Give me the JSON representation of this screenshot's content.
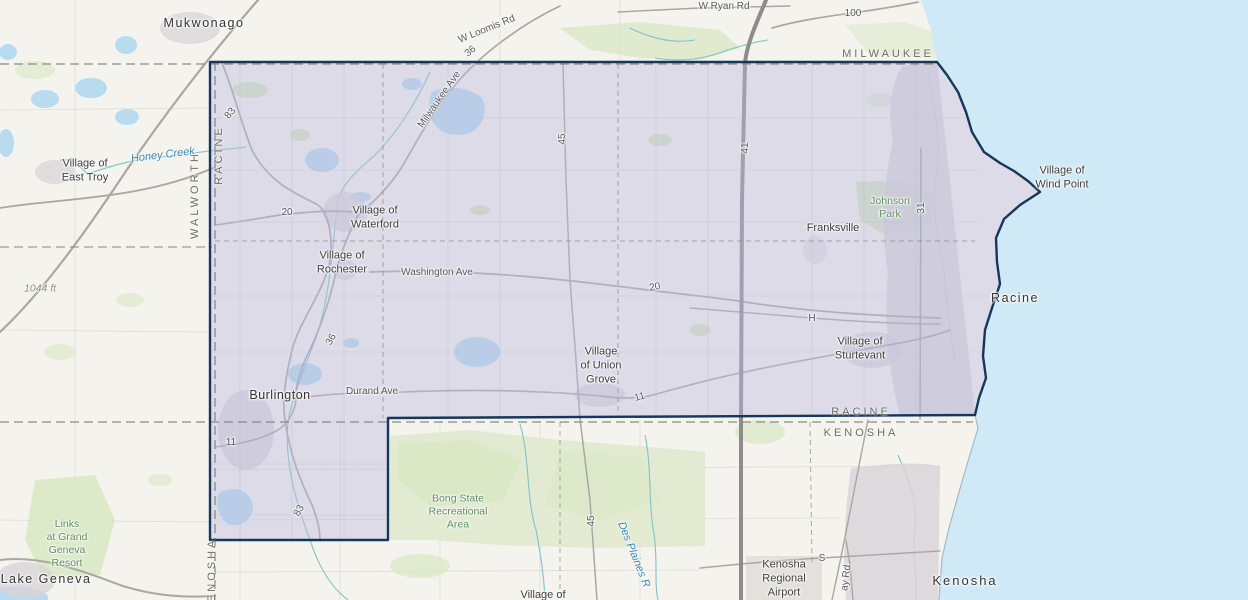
{
  "map": {
    "colors": {
      "land": "#f4f3ed",
      "lake": "#cfeaf6",
      "lake_small": "#b9dbf0",
      "veg": "#d8e7c3",
      "veg_light": "#e2ebd2",
      "region_fill": "#b9b9e0",
      "region_opacity": "0.42",
      "region_border": "#16365c",
      "road": "#a9a7a3",
      "highway": "#8e8c8c",
      "stream": "#7fc3c8",
      "urban": "#d9d3d8",
      "dashed": "#8a8a82",
      "grid_in": "#b9b9cf",
      "grid_out": "#dfddd2"
    },
    "labels": {
      "cities": {
        "mukwonago": "Mukwonago",
        "east_troy": "Village of\nEast Troy",
        "waterford": "Village of\nWaterford",
        "rochester": "Village of\nRochester",
        "franksville": "Franksville",
        "wind_point": "Village of\nWind Point",
        "racine": "Racine",
        "sturtevant": "Village of\nSturtevant",
        "union_grove": "Village\nof Union\nGrove",
        "burlington": "Burlington",
        "kenosha": "Kenosha",
        "lake_geneva": "Lake Geneva",
        "village_partial": "Village of"
      },
      "counties": {
        "walworth": "WALWORTH",
        "racine_west": "RACINE",
        "milwaukee": "MILWAUKEE",
        "racine_south": "RACINE",
        "kenosha_south": "KENOSHA",
        "kenosha_west": "KENOSHA"
      },
      "roads": {
        "w_ryan_rd": "W Ryan Rd",
        "hwy_100": "100",
        "w_loomis_rd": "W Loomis Rd",
        "hwy_36_top": "36",
        "milwaukee_ave": "Milwaukee Ave",
        "hwy_45_top": "45",
        "hwy_41": "41",
        "hwy_83_top": "83",
        "hwy_20_west": "20",
        "washington_ave": "Washington Ave",
        "hwy_20_east": "20",
        "hwy_31": "31",
        "road_h": "H",
        "hwy_11_west": "11",
        "hwy_36_south": "36",
        "durand_ave": "Durand Ave",
        "hwy_11_east": "11",
        "hwy_83_south": "83",
        "hwy_45_south": "45",
        "road_s": "S",
        "bay_rd": "ay Rd"
      },
      "parks": {
        "johnson_park": "Johnson\nPark",
        "bong": "Bong State\nRecreational\nArea",
        "links_resort": "Links\nat Grand\nGeneva\nResort"
      },
      "water": {
        "honey_creek": "Honey Creek",
        "des_plaines": "Des Plaines R"
      },
      "misc": {
        "elevation": "1044 ft",
        "airport": "Kenosha\nRegional\nAirport"
      }
    }
  }
}
